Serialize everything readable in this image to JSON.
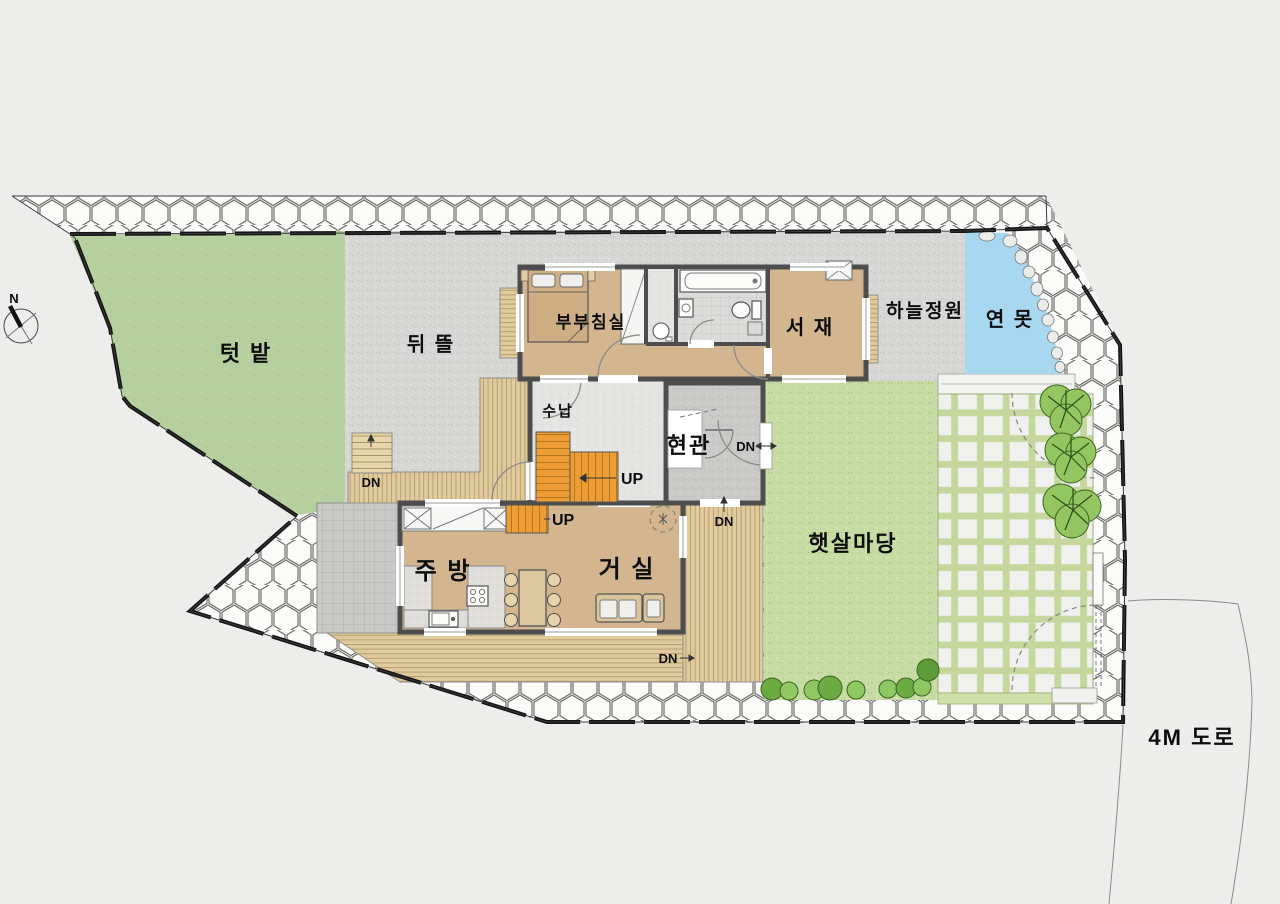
{
  "site": {
    "labels": {
      "vegetable_garden": "텃 밭",
      "backyard": "뒤 뜰",
      "sky_garden": "하늘정원",
      "pond": "연 못",
      "sunny_yard": "햇살마당",
      "road": "4M 도로"
    }
  },
  "rooms": {
    "master_bedroom": "부부침실",
    "study": "서 재",
    "storage": "수납",
    "entrance": "현관",
    "kitchen": "주 방",
    "living": "거 실"
  },
  "stairs": {
    "up": "UP",
    "down": "DN"
  },
  "compass": {
    "north": "N"
  },
  "colors": {
    "vegetable_garden": "#b6cf9f",
    "backyard_paving": "#d7d7d5",
    "lawn": "#c7dba4",
    "pond": "#a7d8f0",
    "room_floor": "#d3b690",
    "deck": "#e0cb9f",
    "stair": "#ee9d35",
    "wall": "#4d4d4d",
    "tree": "#93c661",
    "boundary": "#141414"
  }
}
